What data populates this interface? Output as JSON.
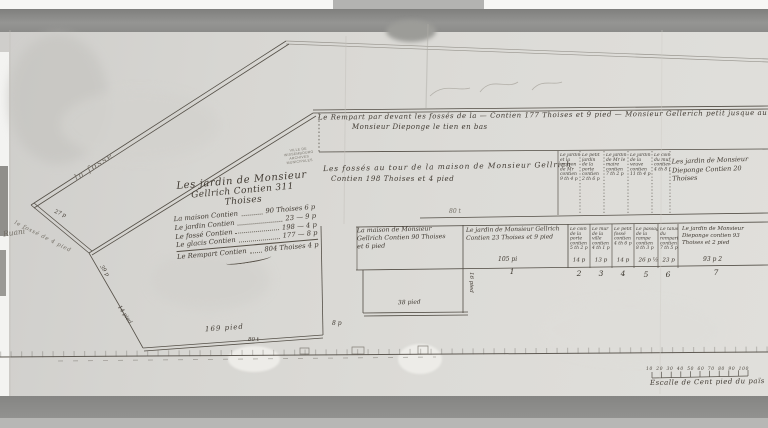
{
  "palette": {
    "paper": "#d9d8d4",
    "ink": "#3e3933",
    "scan_band": "#8d8d8b"
  },
  "labels": {
    "rempart_line1": "Le Rempart par devant les fossés de la — Contien 177 Thoises et 9 pied — Monsieur Gellerich petit jusque au jardin de",
    "rempart_line2": "Monsieur Dieponge le tien en bas",
    "fosses_line1": "Les fossés au tour de la maison de Monsieur Gellrich",
    "fosses_line2": "Contien 198 Thoises et 4 pied",
    "la_fosse": "la fosse",
    "margin_word": "Ruani"
  },
  "measures": {
    "m27": "27 p",
    "fosse_edge": "le fossé de 4 pied",
    "m39": "39 p",
    "m14": "14 pied",
    "m169": "169 pied",
    "m80": "80 t",
    "m38": "38 pied",
    "m16": "16 pied",
    "m8": "8 p",
    "m80b": "80 t"
  },
  "title_block": {
    "title1": "Les jardin de Monsieur",
    "title2": "Gellrich Contien 311 Thoises",
    "items": [
      {
        "label": "La maison Contien",
        "value": "90 Thoises 6 p"
      },
      {
        "label": "Le jardin Contien",
        "value": "23 — 9 p"
      },
      {
        "label": "Le fossé Contien",
        "value": "198 — 4 p"
      },
      {
        "label": "Le glacis Contien",
        "value": "177 — 8 p"
      },
      {
        "label": "Le Rempart Contien",
        "value": "804 Thoises 4 p"
      }
    ]
  },
  "stamp": {
    "lines": [
      "VILLE DE WISSEMBOURG",
      "ARCHIVES",
      "MUNICIPALES"
    ]
  },
  "blocks": {
    "maison": {
      "lines": [
        "La maison de Monsieur",
        "Gellrich Contien 90 Thoises",
        "et 6 pied"
      ]
    },
    "jardin": {
      "lines": [
        "Le jardin de Monsieur Gellrich",
        "Contien 23 Thoises et 9 pied"
      ],
      "width": "105 pi",
      "num": "1"
    },
    "dieponge_top": {
      "lines": [
        "Les jardin de Monsieur",
        "Dieponge Contien 20 Thoises"
      ]
    },
    "dieponge_bottom": {
      "lines": [
        "Le jardin de Monsieur",
        "Dieponge contien 93",
        "Thoises et 2 pied"
      ],
      "width": "93 p 2",
      "num": "7"
    }
  },
  "top_table": {
    "columns": [
      {
        "lines": [
          "Le jardin",
          "et la",
          "maison",
          "de Mr",
          "contien",
          "9 th 4 p"
        ]
      },
      {
        "lines": [
          "Le petit",
          "jardin",
          "de la",
          "porte",
          "contien",
          "2 th 6 p"
        ]
      },
      {
        "lines": [
          "Le jardin",
          "de Mr le",
          "maire",
          "contien",
          "7 th 2 p"
        ]
      },
      {
        "lines": [
          "Le jardin",
          "de la",
          "veuve",
          "contien",
          "11 th 4 p"
        ]
      },
      {
        "lines": [
          "Le coin",
          "du mur",
          "contien",
          "4 th 8 p"
        ]
      }
    ]
  },
  "bottom_table": {
    "columns": [
      {
        "lines": [
          "Le coin",
          "de la",
          "porte",
          "contien",
          "5 th 2 p"
        ],
        "width": "14 p",
        "num": "2"
      },
      {
        "lines": [
          "Le mur",
          "de la",
          "ville",
          "contien",
          "4 th 1 p"
        ],
        "width": "13 p",
        "num": "3"
      },
      {
        "lines": [
          "Le petit",
          "fossé",
          "contien",
          "4 th 6 p"
        ],
        "width": "14 p",
        "num": "4"
      },
      {
        "lines": [
          "Le passage",
          "de la",
          "rampe",
          "contien",
          "8 th 3 p"
        ],
        "width": "26 p ½",
        "num": "5"
      },
      {
        "lines": [
          "Le talus",
          "du",
          "rempart",
          "contien",
          "7 th 5 p"
        ],
        "width": "23 p",
        "num": "6"
      }
    ]
  },
  "scale_bar": {
    "numbers": "10 20 30 40 50 60 70 80 90 100",
    "caption": "Escalle de Cent pied du païs"
  }
}
